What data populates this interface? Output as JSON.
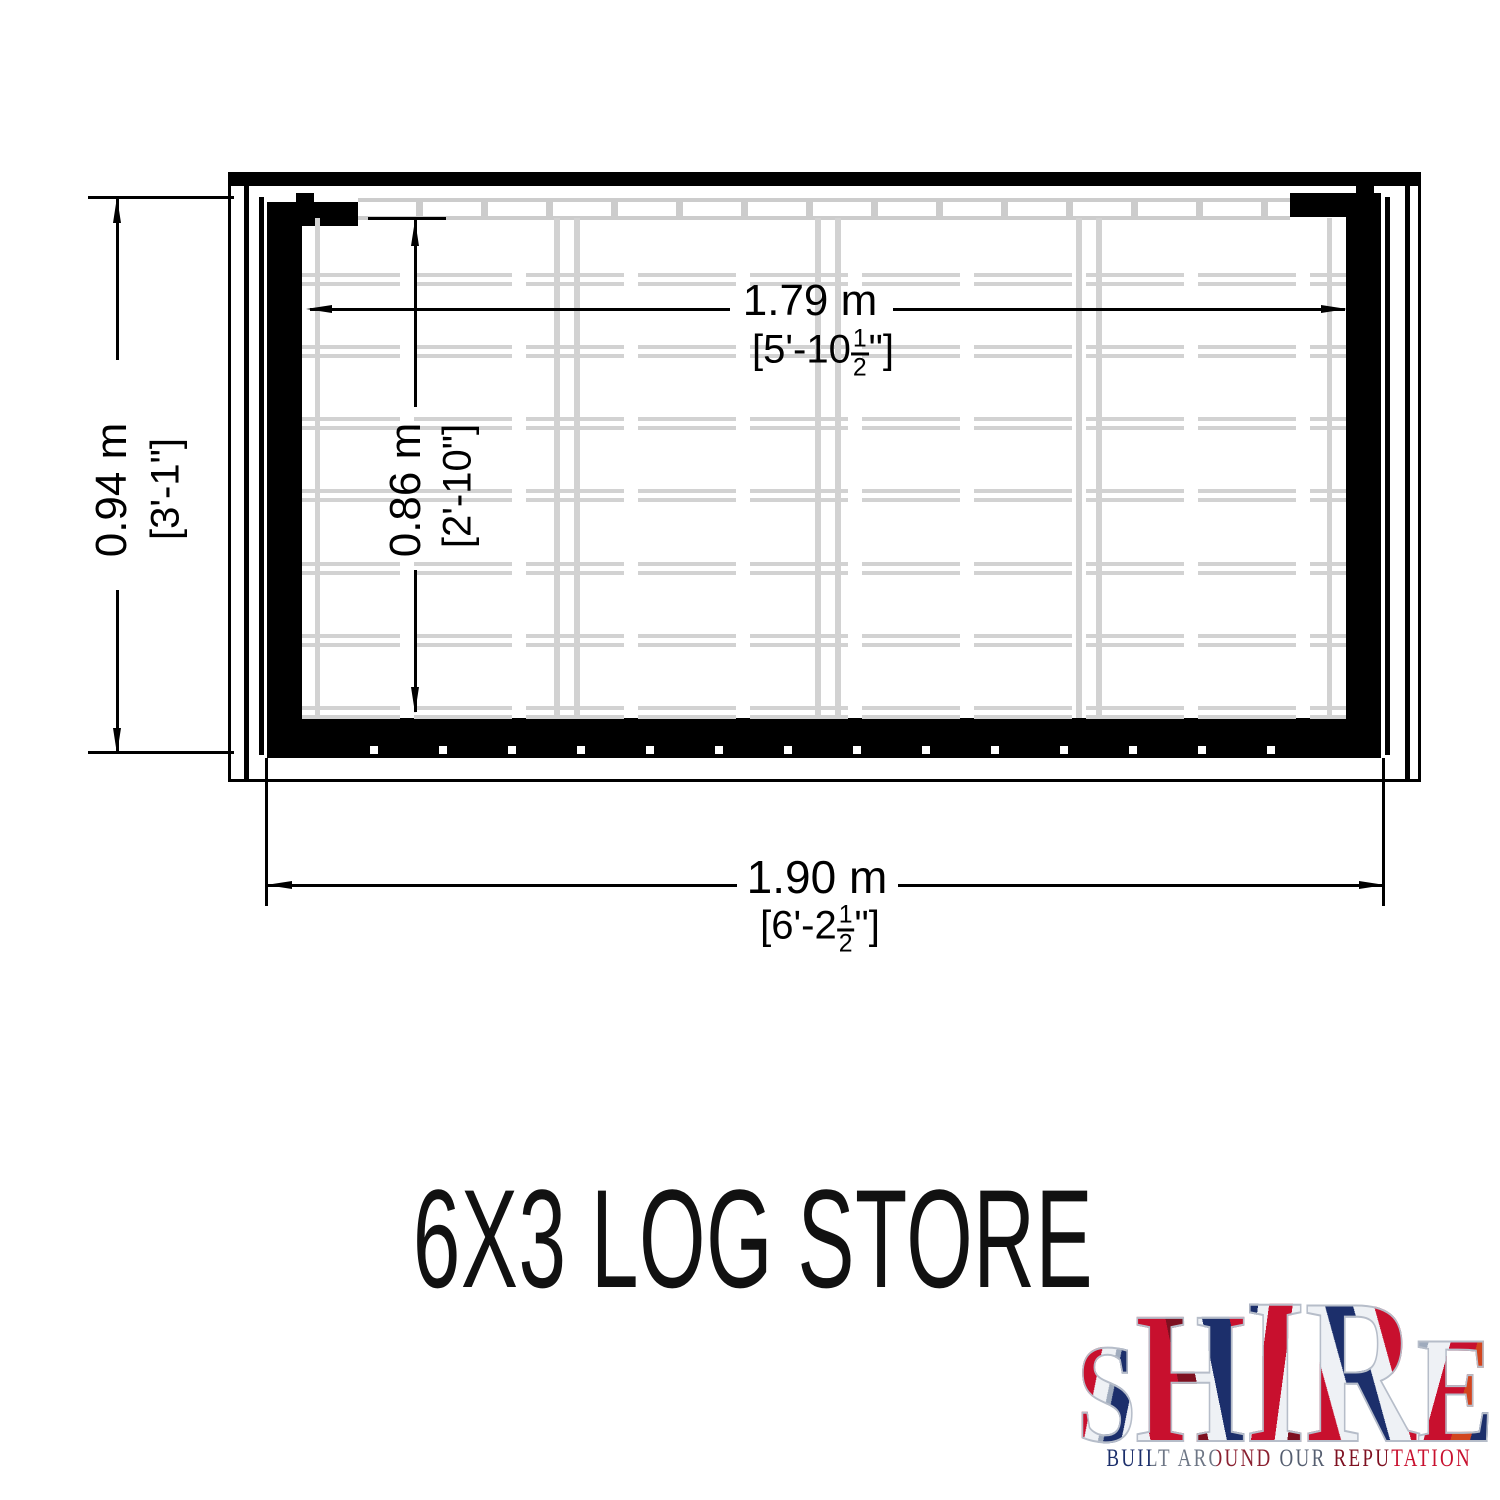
{
  "palette": {
    "line": "#000000",
    "slat_gray": "#d2d2d2",
    "logo_red": "#c8102e",
    "logo_navy": "#1c2f6b",
    "logo_silver": "#eef1f5"
  },
  "drawing": {
    "title": "6X3 LOG STORE",
    "dimensions": {
      "inner_width": {
        "metric": "1.79 m",
        "imp_pre": "[5'-10",
        "frac_num": "1",
        "frac_den": "2",
        "imp_post": "\"]"
      },
      "outer_width": {
        "metric": "1.90 m",
        "imp_pre": "[6'-2",
        "frac_num": "1",
        "frac_den": "2",
        "imp_post": "\"]"
      },
      "inner_depth": {
        "metric": "0.86 m",
        "imperial": "[2'-10\"]"
      },
      "outer_depth": {
        "metric": "0.94 m",
        "imperial": "[3'-1\"]"
      }
    }
  },
  "logo": {
    "letters": [
      "S",
      "H",
      "I",
      "R",
      "E"
    ],
    "tagline": "BUILT AROUND OUR REPUTATION"
  }
}
